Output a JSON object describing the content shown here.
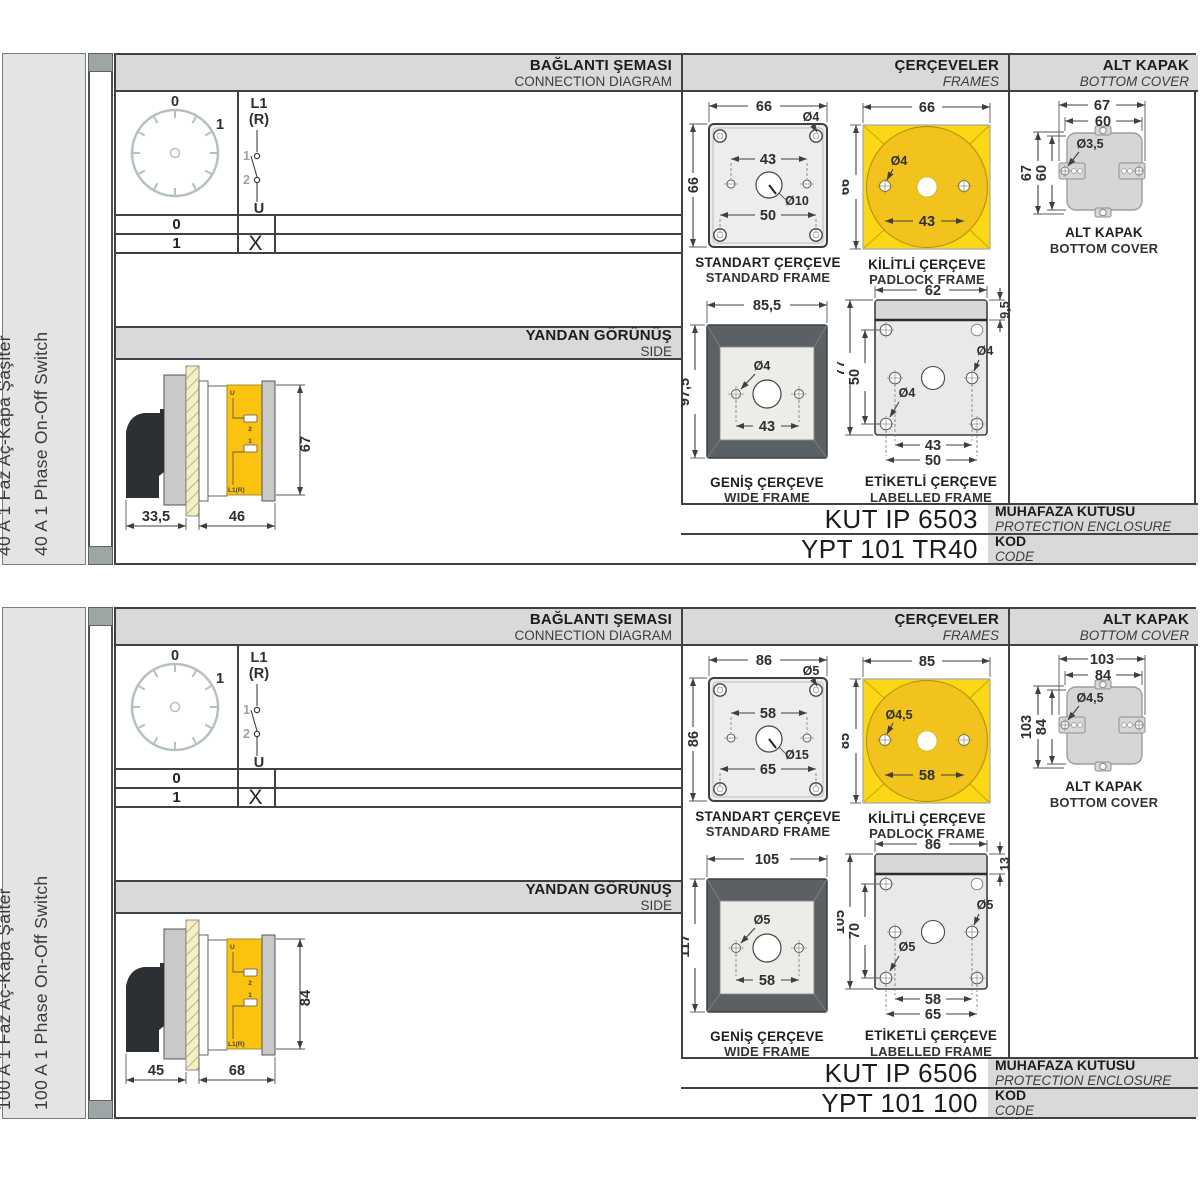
{
  "colors": {
    "accent_yellow": "#FBD815",
    "padlock_circle": "#F2C31C",
    "wide_frame_dark": "#5B6065",
    "header_bg": "#D9D9D9",
    "side_panel_bg": "#E4E4E4",
    "line": "#3E4246",
    "switch_body_yellow": "#FCC30E"
  },
  "sections": [
    {
      "side_label_tr": "40 A 1 Faz Aç-Kapa Şaşlter",
      "side_label_en": "40 A 1 Phase On-Off Switch",
      "headers": {
        "connection_tr": "BAĞLANTI ŞEMASI",
        "connection_en": "CONNECTION DIAGRAM",
        "frames_tr": "ÇERÇEVELER",
        "frames_en": "FRAMES",
        "cover_tr": "ALT KAPAK",
        "cover_en": "BOTTOM COVER",
        "side_tr": "YANDAN GÖRÜNÜŞ",
        "side_en": "SIDE"
      },
      "diagram": {
        "pos0": "0",
        "pos1": "1",
        "l1": "L1",
        "r": "(R)",
        "c1": "1",
        "c2": "2",
        "u": "U",
        "rows": [
          {
            "pos": "0",
            "mark": ""
          },
          {
            "pos": "1",
            "mark": "X"
          }
        ]
      },
      "side_view": {
        "d1": "33,5",
        "d2": "46",
        "dh": "67",
        "u": "U",
        "t1": "1",
        "t2": "2",
        "l1r": "L1(R)"
      },
      "frames": {
        "standard": {
          "tr": "STANDART ÇERÇEVE",
          "en": "STANDARD FRAME",
          "w": "66",
          "h": "66",
          "inner": "43",
          "lower": "50",
          "hole": "Ø4",
          "center": "Ø10"
        },
        "padlock": {
          "tr": "KİLİTLİ ÇERÇEVE",
          "en": "PADLOCK FRAME",
          "w": "66",
          "h": "66",
          "hole": "Ø4",
          "inner": "43"
        },
        "wide": {
          "tr": "GENİŞ ÇERÇEVE",
          "en": "WIDE FRAME",
          "w": "85,5",
          "h": "97,5",
          "hole": "Ø4",
          "inner": "43"
        },
        "labelled": {
          "tr": "ETİKETLİ ÇERÇEVE",
          "en": "LABELLED FRAME",
          "w": "62",
          "strip": "9,5",
          "h": "77",
          "inner_h": "50",
          "hole_r": "Ø4",
          "hole_l": "Ø4",
          "inner": "43",
          "lower": "50"
        }
      },
      "cover": {
        "tr": "ALT KAPAK",
        "en": "BOTTOM COVER",
        "w": "67",
        "w2": "60",
        "h": "67",
        "h2": "60",
        "hole": "Ø3,5"
      },
      "codes": {
        "enclosure": "KUT IP 6503",
        "enclosure_tr": "MUHAFAZA KUTUSU",
        "enclosure_en": "PROTECTION ENCLOSURE",
        "code": "YPT 101 TR40",
        "code_tr": "KOD",
        "code_en": "CODE"
      }
    },
    {
      "side_label_tr": "100 A 1 Faz Aç-Kapa Şalter",
      "side_label_en": "100 A 1 Phase On-Off Switch",
      "headers": {
        "connection_tr": "BAĞLANTI ŞEMASI",
        "connection_en": "CONNECTION DIAGRAM",
        "frames_tr": "ÇERÇEVELER",
        "frames_en": "FRAMES",
        "cover_tr": "ALT KAPAK",
        "cover_en": "BOTTOM COVER",
        "side_tr": "YANDAN GÖRÜNÜŞ",
        "side_en": "SIDE"
      },
      "diagram": {
        "pos0": "0",
        "pos1": "1",
        "l1": "L1",
        "r": "(R)",
        "c1": "1",
        "c2": "2",
        "u": "U",
        "rows": [
          {
            "pos": "0",
            "mark": ""
          },
          {
            "pos": "1",
            "mark": "X"
          }
        ]
      },
      "side_view": {
        "d1": "45",
        "d2": "68",
        "dh": "84",
        "u": "U",
        "t1": "1",
        "t2": "2",
        "l1r": "L1(R)"
      },
      "frames": {
        "standard": {
          "tr": "STANDART ÇERÇEVE",
          "en": "STANDARD FRAME",
          "w": "86",
          "h": "86",
          "inner": "58",
          "lower": "65",
          "hole": "Ø5",
          "center": "Ø15"
        },
        "padlock": {
          "tr": "KİLİTLİ ÇERÇEVE",
          "en": "PADLOCK FRAME",
          "w": "85",
          "h": "85",
          "hole": "Ø4,5",
          "inner": "58"
        },
        "wide": {
          "tr": "GENİŞ ÇERÇEVE",
          "en": "WIDE FRAME",
          "w": "105",
          "h": "117",
          "hole": "Ø5",
          "inner": "58"
        },
        "labelled": {
          "tr": "ETİKETLİ ÇERÇEVE",
          "en": "LABELLED FRAME",
          "w": "86",
          "strip": "13",
          "h": "105",
          "inner_h": "70",
          "hole_r": "Ø5",
          "hole_l": "Ø5",
          "inner": "58",
          "lower": "65"
        }
      },
      "cover": {
        "tr": "ALT KAPAK",
        "en": "BOTTOM COVER",
        "w": "103",
        "w2": "84",
        "h": "103",
        "h2": "84",
        "hole": "Ø4,5"
      },
      "codes": {
        "enclosure": "KUT IP 6506",
        "enclosure_tr": "MUHAFAZA KUTUSU",
        "enclosure_en": "PROTECTION ENCLOSURE",
        "code": "YPT 101 100",
        "code_tr": "KOD",
        "code_en": "CODE"
      }
    }
  ]
}
